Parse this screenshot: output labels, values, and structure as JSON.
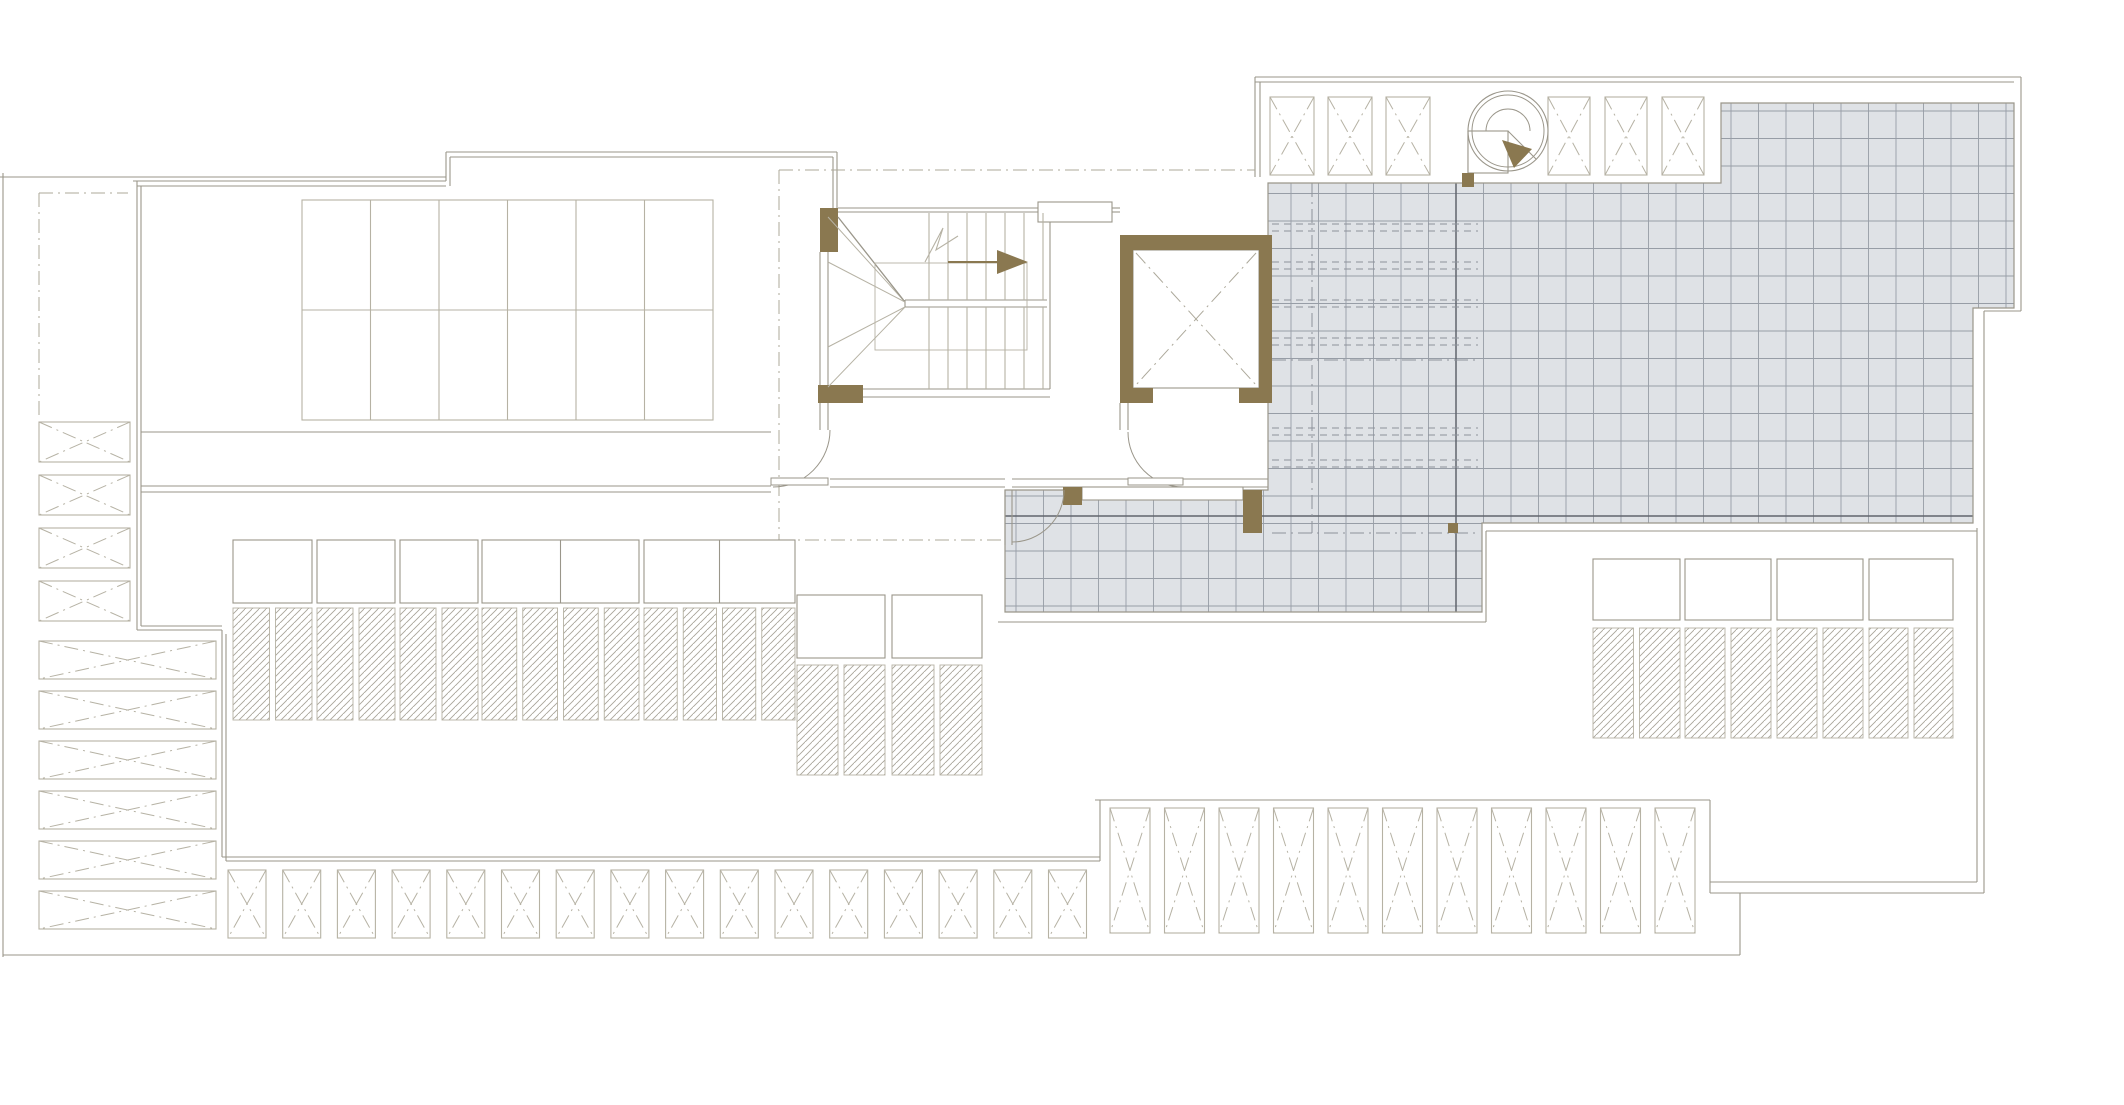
{
  "title": "architectural-roof-plan",
  "canvas": {
    "w": 2124,
    "h": 1105,
    "bg": "#ffffff"
  },
  "colors": {
    "line": "#9a968a",
    "lineLight": "#b6b2a4",
    "dash": "#aca89a",
    "brown": "#8a7850",
    "tileFill": "#dfe2e6",
    "tileLine": "#979da6",
    "tileDark": "#60656d",
    "white": "#ffffff"
  },
  "terrace": {
    "points": [
      [
        1268,
        183
      ],
      [
        1721,
        183
      ],
      [
        1721,
        103
      ],
      [
        2014,
        103
      ],
      [
        2014,
        308
      ],
      [
        1973,
        308
      ],
      [
        1973,
        523
      ],
      [
        1482,
        523
      ],
      [
        1482,
        612
      ],
      [
        1005,
        612
      ],
      [
        1005,
        490
      ],
      [
        1268,
        490
      ]
    ],
    "pitch": 27.5,
    "gridStartX": 1016,
    "gridStartY": 111,
    "darkJoints": [
      [
        1456,
        183,
        1456,
        612
      ],
      [
        1005,
        516,
        1973,
        516
      ]
    ],
    "hiddenDashRows": {
      "ys": [
        224,
        231,
        262,
        269,
        300,
        307,
        338,
        345,
        428,
        435,
        460,
        467
      ],
      "x1": 1272,
      "x2": 1478
    },
    "hiddenDashDot": [
      [
        1312,
        183,
        1312,
        533
      ],
      [
        1272,
        360,
        1478,
        360
      ],
      [
        1272,
        533,
        1478,
        533
      ]
    ]
  },
  "outline_lines": [
    [
      3,
      173,
      3,
      957
    ],
    [
      3,
      955,
      1740,
      955
    ],
    [
      0,
      177,
      446,
      177
    ],
    [
      133,
      181,
      446,
      181
    ],
    [
      137,
      186,
      446,
      186
    ],
    [
      446,
      181,
      446,
      152
    ],
    [
      450,
      186,
      450,
      157
    ],
    [
      446,
      152,
      837,
      152
    ],
    [
      450,
      157,
      833,
      157
    ],
    [
      833,
      157,
      833,
      208
    ],
    [
      837,
      152,
      837,
      208
    ],
    [
      137,
      181,
      137,
      630
    ],
    [
      141,
      186,
      141,
      626
    ],
    [
      137,
      630,
      222,
      630
    ],
    [
      141,
      626,
      222,
      626
    ],
    [
      222,
      630,
      222,
      857
    ],
    [
      226,
      634,
      226,
      861
    ],
    [
      222,
      857,
      1100,
      857
    ],
    [
      226,
      861,
      1100,
      861
    ],
    [
      1100,
      861,
      1100,
      800
    ],
    [
      1095,
      800,
      1710,
      800
    ],
    [
      1710,
      800,
      1710,
      893
    ],
    [
      1710,
      882,
      1977,
      882
    ],
    [
      1710,
      893,
      1984,
      893
    ],
    [
      1740,
      893,
      1740,
      955
    ],
    [
      1977,
      528,
      1977,
      882
    ],
    [
      1984,
      311,
      1984,
      893
    ],
    [
      2021,
      77,
      2021,
      311
    ],
    [
      2021,
      311,
      1984,
      311
    ],
    [
      1255,
      77,
      2021,
      77
    ],
    [
      1255,
      82,
      2014,
      82
    ],
    [
      1255,
      77,
      1255,
      177
    ],
    [
      1260,
      82,
      1260,
      177
    ],
    [
      141,
      432,
      771,
      432
    ],
    [
      141,
      486,
      771,
      486
    ],
    [
      141,
      492,
      771,
      492
    ],
    [
      830,
      479,
      1005,
      479
    ],
    [
      830,
      487,
      1005,
      487
    ],
    [
      1012,
      479,
      1128,
      479
    ],
    [
      1012,
      487,
      1128,
      487
    ],
    [
      1183,
      479,
      1268,
      479
    ],
    [
      1183,
      487,
      1268,
      487
    ],
    [
      863,
      389,
      1050,
      389
    ],
    [
      863,
      397,
      1050,
      397
    ],
    [
      820,
      252,
      820,
      385
    ],
    [
      828,
      252,
      828,
      385
    ],
    [
      838,
      208,
      1038,
      208
    ],
    [
      838,
      212,
      1038,
      212
    ],
    [
      1112,
      208,
      1120,
      208
    ],
    [
      1112,
      212,
      1120,
      212
    ],
    [
      1050,
      212,
      1050,
      389
    ],
    [
      820,
      403,
      820,
      430
    ],
    [
      828,
      403,
      828,
      430
    ],
    [
      1120,
      403,
      1120,
      430
    ],
    [
      1128,
      403,
      1128,
      430
    ],
    [
      998,
      622,
      1486,
      622
    ],
    [
      1486,
      622,
      1486,
      531
    ],
    [
      1486,
      531,
      1977,
      531
    ],
    [
      1468,
      131,
      1468,
      173
    ],
    [
      1468,
      173,
      1508,
      173
    ],
    [
      905,
      300,
      1047,
      300
    ],
    [
      905,
      307,
      1047,
      307
    ],
    [
      905,
      300,
      905,
      307
    ],
    [
      1005,
      490,
      1005,
      545
    ],
    [
      1012,
      490,
      1012,
      545
    ],
    [
      1038,
      212,
      1112,
      212
    ],
    [
      1150,
      378,
      1242,
      378
    ],
    [
      1196,
      371,
      1196,
      386
    ]
  ],
  "stair": {
    "treads": {
      "x0": 929,
      "step": 19,
      "count": 7,
      "segs": [
        [
          213,
          300
        ],
        [
          307,
          389
        ]
      ]
    },
    "winders": [
      [
        828,
        217,
        905,
        302
      ],
      [
        838,
        217,
        905,
        302
      ],
      [
        828,
        262,
        905,
        302
      ],
      [
        828,
        347,
        905,
        307
      ],
      [
        828,
        387,
        905,
        307
      ]
    ],
    "innerRect": [
      875,
      263,
      152,
      87
    ],
    "zigzag": [
      [
        925,
        262
      ],
      [
        943,
        228
      ],
      [
        936,
        250
      ],
      [
        958,
        236
      ]
    ],
    "arrowTail": [
      948,
      262,
      997,
      262
    ],
    "arrow": [
      [
        997,
        250
      ],
      [
        997,
        274
      ],
      [
        1028,
        262
      ]
    ]
  },
  "dashdot_lines": [
    [
      779,
      170,
      1255,
      170
    ],
    [
      779,
      170,
      779,
      540
    ],
    [
      779,
      540,
      1005,
      540
    ],
    [
      39,
      193,
      128,
      193
    ],
    [
      39,
      193,
      39,
      418
    ],
    [
      1136,
      253,
      1256,
      385
    ],
    [
      1256,
      253,
      1136,
      385
    ]
  ],
  "white_rects": [
    [
      1038,
      202,
      74,
      20
    ],
    [
      1150,
      371,
      92,
      15
    ],
    [
      1082,
      487,
      161,
      13
    ],
    [
      1468,
      131,
      40,
      42
    ]
  ],
  "brown_rects": [
    [
      820,
      208,
      18,
      44
    ],
    [
      818,
      385,
      45,
      18
    ],
    [
      1120,
      235,
      152,
      15
    ],
    [
      1120,
      235,
      13,
      168
    ],
    [
      1259,
      235,
      13,
      168
    ],
    [
      1120,
      388,
      33,
      15
    ],
    [
      1239,
      388,
      33,
      15
    ],
    [
      1063,
      487,
      19,
      18
    ],
    [
      1243,
      490,
      19,
      43
    ],
    [
      1448,
      523,
      10,
      10
    ],
    [
      1462,
      173,
      12,
      14
    ]
  ],
  "elevator_cab": [
    1133,
    250,
    126,
    138
  ],
  "panel_grid": {
    "x": 302,
    "y": 200,
    "w": 411,
    "h": 220,
    "cols": 6,
    "rows": 2
  },
  "xbox_rows": [
    {
      "name": "left-narrow-vents",
      "x": 39,
      "w": 91,
      "y0": 422,
      "h": 40,
      "pitch": 53,
      "count": 4
    },
    {
      "name": "left-wide-vents",
      "x": 39,
      "w": 177,
      "y0": 641,
      "h": 38,
      "pitch": 50,
      "count": 6
    },
    {
      "name": "bottom-small-vents",
      "x": 228,
      "w": 38,
      "y0": 870,
      "h": 68,
      "pitch": 54.7,
      "count": 16
    },
    {
      "name": "bottom-tall-vents",
      "x": 1110,
      "w": 40,
      "y0": 808,
      "h": 125,
      "pitch": 54.5,
      "count": 11
    },
    {
      "name": "top-vents-left",
      "x": 1270,
      "w": 44,
      "y0": 97,
      "h": 78,
      "pitch": 58,
      "count": 3
    },
    {
      "name": "top-vents-right",
      "x": 1548,
      "w": 42,
      "y0": 97,
      "h": 78,
      "pitch": 57,
      "count": 3
    }
  ],
  "skylight_rows": [
    {
      "name": "skylights-left",
      "yW": 540,
      "hW": 63,
      "yH": 608,
      "hH": 112,
      "groups": [
        {
          "x": 233,
          "w": 79,
          "wc": 1,
          "hc": 2
        },
        {
          "x": 317,
          "w": 78,
          "wc": 1,
          "hc": 2
        },
        {
          "x": 400,
          "w": 78,
          "wc": 1,
          "hc": 2
        },
        {
          "x": 482,
          "w": 157,
          "wc": 2,
          "hc": 4
        },
        {
          "x": 644,
          "w": 151,
          "wc": 2,
          "hc": 4
        }
      ]
    },
    {
      "name": "skylights-middle",
      "yW": 595,
      "hW": 63,
      "yH": 665,
      "hH": 110,
      "groups": [
        {
          "x": 797,
          "w": 88,
          "wc": 1,
          "hc": 2
        },
        {
          "x": 892,
          "w": 90,
          "wc": 1,
          "hc": 2
        }
      ]
    },
    {
      "name": "skylights-right",
      "yW": 559,
      "hW": 61,
      "yH": 628,
      "hH": 110,
      "groups": [
        {
          "x": 1593,
          "w": 87,
          "wc": 1,
          "hc": 2
        },
        {
          "x": 1685,
          "w": 86,
          "wc": 1,
          "hc": 2
        },
        {
          "x": 1777,
          "w": 86,
          "wc": 1,
          "hc": 2
        },
        {
          "x": 1869,
          "w": 84,
          "wc": 1,
          "hc": 2
        }
      ]
    }
  ],
  "doors": [
    {
      "d": "M 830,430 A 57,57 0 0 1 773,487",
      "leaf": [
        771,
        478,
        57,
        7
      ]
    },
    {
      "d": "M 1128,432 A 55,55 0 0 0 1183,487",
      "leaf": [
        1128,
        478,
        55,
        7
      ]
    },
    {
      "d": "M 1012,542 A 52,52 0 0 0 1064,490",
      "leaf": null
    }
  ],
  "spiral": {
    "cx": 1508,
    "cy": 131,
    "rOuter": 40,
    "rInner": 36,
    "arc": "M 1486,131 A 22,22 0 0 1 1530,131",
    "radial": [
      1508,
      131,
      1536,
      159
    ],
    "arrow": [
      [
        1502,
        140
      ],
      [
        1514,
        168
      ],
      [
        1532,
        149
      ]
    ]
  }
}
